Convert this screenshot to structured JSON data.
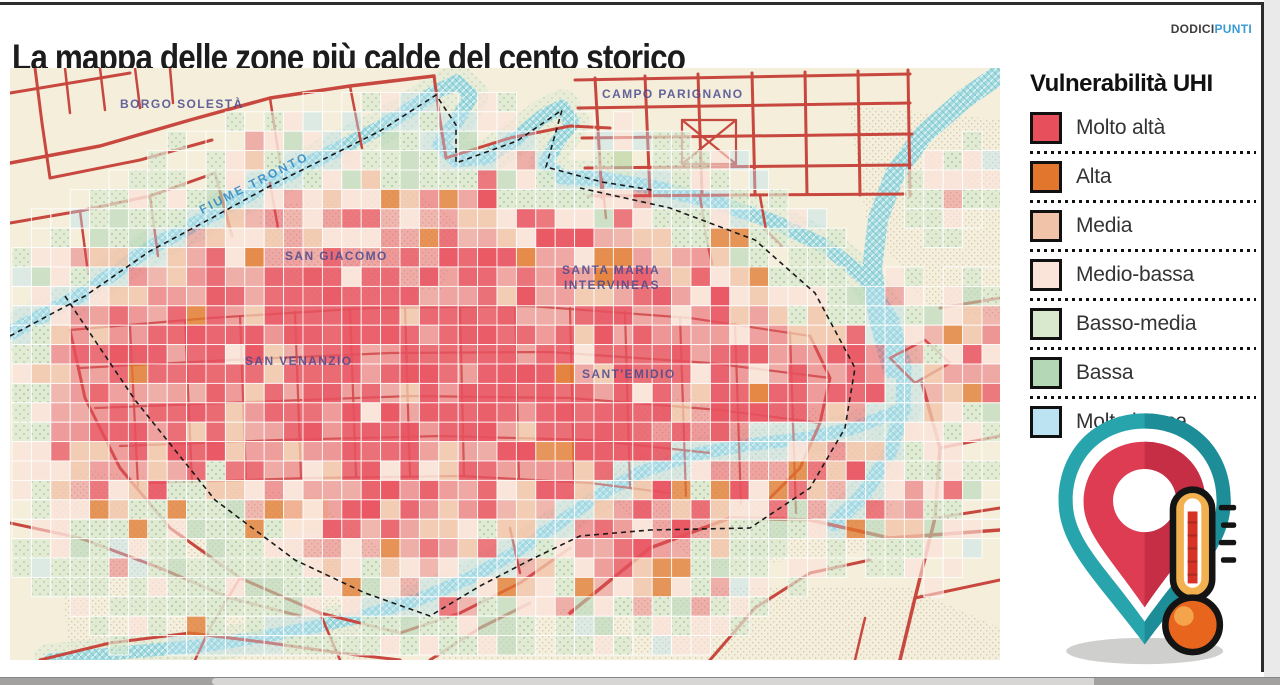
{
  "header": {
    "title": "La mappa delle zone più calde del cento storico",
    "brand_part1": "DODICI",
    "brand_part2": "PUNTI"
  },
  "legend": {
    "title": "Vulnerabilità UHI",
    "items": [
      {
        "label": "Molto altà",
        "color": "#e84f5c"
      },
      {
        "label": "Alta",
        "color": "#e2762d"
      },
      {
        "label": "Media",
        "color": "#f1c3a9"
      },
      {
        "label": "Medio-bassa",
        "color": "#fae3d9"
      },
      {
        "label": "Basso-media",
        "color": "#d9e9cd"
      },
      {
        "label": "Bassa",
        "color": "#b4d7b6"
      },
      {
        "label": "Molto bassa",
        "color": "#bce3f2"
      }
    ]
  },
  "map": {
    "background": "#f4eedb",
    "road_color": "#c8483f",
    "road_color_inner": "#c0463e",
    "river_color": "#a4dade",
    "boundary_color": "#1a1a1a",
    "district_label_color": "#4a4a8f",
    "river_label_color": "#2d85c5",
    "palette": {
      "molto_alta": "#e8515f",
      "alta": "#e2772e",
      "media": "#f1c3a9",
      "medio_bassa": "#fae3d9",
      "basso_media": "#dcead0",
      "bassa": "#b4d7b6",
      "molto_bassa": "#bce3f2"
    },
    "labels": [
      {
        "text": "BORGO SOLESTÀ",
        "x": 110,
        "y": 40,
        "rot": 0,
        "kind": "district"
      },
      {
        "text": "CAMPO PARIGNANO",
        "x": 592,
        "y": 30,
        "rot": 0,
        "kind": "district"
      },
      {
        "text": "FIUME TRONTO",
        "x": 192,
        "y": 146,
        "rot": -27,
        "kind": "river"
      },
      {
        "text": "SAN GIACOMO",
        "x": 275,
        "y": 192,
        "rot": 0,
        "kind": "district"
      },
      {
        "text": "SANTA MARIA",
        "x": 552,
        "y": 206,
        "rot": 0,
        "kind": "district"
      },
      {
        "text": "INTERVINEAS",
        "x": 554,
        "y": 221,
        "rot": 0,
        "kind": "district"
      },
      {
        "text": "SAN VENANZIO",
        "x": 235,
        "y": 297,
        "rot": 0,
        "kind": "district"
      },
      {
        "text": "SANT'EMIDIO",
        "x": 572,
        "y": 310,
        "rot": 0,
        "kind": "district"
      }
    ],
    "rivers": [
      {
        "w": 15,
        "pts": "0,265 75,225 140,180 200,148 260,115 320,85 370,60 402,40 426,24 447,14 461,28 446,54 430,76 446,92 477,89 507,70 532,49 552,39 562,55 546,76 536,96 552,109 592,111 642,119 702,133 762,153 817,179 856,211 881,251 894,296 893,341 879,386 854,426 824,456"
      },
      {
        "w": 20,
        "pts": "990,6 954,31 914,66 885,106 868,151 862,201 869,251 882,300"
      },
      {
        "w": 13,
        "pts": "40,592 120,584 200,577 280,564 350,549 410,531 462,509 506,484 546,457 586,429 631,404 681,387 736,377 791,371 841,361 886,344"
      }
    ],
    "boundaries": [
      {
        "pts": "0,268 75,228 140,183 200,151 260,118 320,88 370,63 426,27 446,57 446,95 507,73 552,42 536,99 592,114 642,122"
      },
      {
        "pts": "55,228 125,332 205,432 285,492 355,525 420,548 470,518 520,492 570,468 640,462 740,460 800,420 835,360 845,300 805,225 745,172 660,140 570,120"
      }
    ],
    "roads": [
      {
        "w": 3,
        "c": "o",
        "pts": "0,25 120,5"
      },
      {
        "w": 3.5,
        "c": "o",
        "pts": "0,95 90,78 180,52 260,30 340,18 424,8"
      },
      {
        "w": 3,
        "c": "o",
        "pts": "25,0 32,55 40,110"
      },
      {
        "w": 2.5,
        "c": "o",
        "pts": "55,0 60,45"
      },
      {
        "w": 2.5,
        "c": "o",
        "pts": "90,0 95,42"
      },
      {
        "w": 2.5,
        "c": "o",
        "pts": "125,0 130,40"
      },
      {
        "w": 2.5,
        "c": "o",
        "pts": "160,0 163,35"
      },
      {
        "w": 3,
        "c": "o",
        "pts": "40,110 130,92 202,72"
      },
      {
        "w": 3,
        "c": "o",
        "pts": "0,155 70,143 140,128 205,105"
      },
      {
        "w": 2.5,
        "c": "o",
        "pts": "140,128 148,188"
      },
      {
        "w": 2.5,
        "c": "o",
        "pts": "70,143 78,205"
      },
      {
        "w": 3,
        "c": "o",
        "pts": "205,105 222,168"
      },
      {
        "w": 2.5,
        "c": "o",
        "pts": "260,30 270,95"
      },
      {
        "w": 2.5,
        "c": "o",
        "pts": "340,18 352,80"
      },
      {
        "w": 3,
        "c": "o",
        "pts": "424,8 430,52 436,90"
      },
      {
        "w": 3,
        "c": "o",
        "pts": "436,90 500,70 560,58 600,60"
      },
      {
        "w": 3,
        "c": "o",
        "pts": "565,12 900,6"
      },
      {
        "w": 3,
        "c": "o",
        "pts": "568,40 900,35"
      },
      {
        "w": 3,
        "c": "o",
        "pts": "572,70 902,66"
      },
      {
        "w": 3,
        "c": "o",
        "pts": "575,100 900,97"
      },
      {
        "w": 3,
        "c": "o",
        "pts": "578,128 895,126"
      },
      {
        "w": 3,
        "c": "o",
        "pts": "585,10 592,130"
      },
      {
        "w": 3,
        "c": "o",
        "pts": "635,8 640,128"
      },
      {
        "w": 3,
        "c": "o",
        "pts": "688,6 692,127"
      },
      {
        "w": 3,
        "c": "o",
        "pts": "742,5 745,126"
      },
      {
        "w": 3,
        "c": "o",
        "pts": "795,4 797,126"
      },
      {
        "w": 3,
        "c": "o",
        "pts": "848,3 850,127"
      },
      {
        "w": 3,
        "c": "o",
        "pts": "898,2 900,128"
      },
      {
        "w": 2.2,
        "c": "o",
        "pts": "672,52 726,52 726,96 672,96 672,52"
      },
      {
        "w": 2.2,
        "c": "o",
        "pts": "672,52 726,96"
      },
      {
        "w": 2.2,
        "c": "o",
        "pts": "726,52 672,96"
      },
      {
        "w": 2.5,
        "c": "o",
        "pts": "750,128 756,162 772,178"
      },
      {
        "w": 2.5,
        "c": "o",
        "pts": "690,128 696,168 702,196"
      },
      {
        "w": 3,
        "c": "o",
        "pts": "930,240 990,230"
      },
      {
        "w": 2.5,
        "c": "o",
        "pts": "880,290 915,272 940,295 905,315 880,290"
      },
      {
        "w": 3.5,
        "c": "o",
        "pts": "912,315 930,380 925,450 905,530 890,592"
      },
      {
        "w": 3,
        "c": "o",
        "pts": "905,530 990,512"
      },
      {
        "w": 3,
        "c": "o",
        "pts": "925,450 990,440"
      },
      {
        "w": 3,
        "c": "o",
        "pts": "930,380 990,368"
      },
      {
        "w": 2.2,
        "c": "i",
        "pts": "60,262 200,250 360,240 520,238 680,250 800,268"
      },
      {
        "w": 2.2,
        "c": "i",
        "pts": "70,300 220,292 380,285 540,284 700,295 820,310"
      },
      {
        "w": 2.2,
        "c": "i",
        "pts": "85,340 240,334 400,328 560,330 710,342 810,355"
      },
      {
        "w": 2.2,
        "c": "i",
        "pts": "110,378 270,372 430,368 580,372 700,385"
      },
      {
        "w": 2.2,
        "c": "i",
        "pts": "140,415 300,410 450,408 580,415 660,425"
      },
      {
        "w": 2.2,
        "c": "i",
        "pts": "120,258 128,418"
      },
      {
        "w": 2.2,
        "c": "i",
        "pts": "175,252 182,415"
      },
      {
        "w": 2.2,
        "c": "i",
        "pts": "230,248 236,412"
      },
      {
        "w": 2.2,
        "c": "i",
        "pts": "285,244 291,410"
      },
      {
        "w": 2.2,
        "c": "i",
        "pts": "340,241 346,408"
      },
      {
        "w": 2.2,
        "c": "i",
        "pts": "395,239 400,408"
      },
      {
        "w": 2.2,
        "c": "i",
        "pts": "450,238 454,408"
      },
      {
        "w": 2.2,
        "c": "i",
        "pts": "505,238 509,410"
      },
      {
        "w": 2.2,
        "c": "i",
        "pts": "560,240 564,415"
      },
      {
        "w": 2.2,
        "c": "i",
        "pts": "615,244 620,420"
      },
      {
        "w": 2.2,
        "c": "i",
        "pts": "670,249 676,428"
      },
      {
        "w": 2.2,
        "c": "i",
        "pts": "725,256 731,436"
      },
      {
        "w": 2.2,
        "c": "i",
        "pts": "780,264 786,445"
      },
      {
        "w": 3,
        "c": "o",
        "pts": "60,262 75,330 110,400 160,460 230,510 310,545 390,565"
      },
      {
        "w": 3,
        "c": "o",
        "pts": "390,565 450,545 510,515 560,480"
      },
      {
        "w": 2.5,
        "c": "o",
        "pts": "310,545 330,592"
      },
      {
        "w": 2.5,
        "c": "o",
        "pts": "230,510 200,560 185,592"
      },
      {
        "w": 3,
        "c": "o",
        "pts": "800,268 820,310 810,355 790,400 760,430"
      },
      {
        "w": 3,
        "c": "o",
        "pts": "0,455 70,470 150,500 220,530 290,548"
      },
      {
        "w": 3,
        "c": "o",
        "pts": "30,592 100,575 180,565 260,575 330,585 390,592"
      },
      {
        "w": 3,
        "c": "o",
        "pts": "420,592 470,560 520,535"
      },
      {
        "w": 3.5,
        "c": "o",
        "pts": "560,545 640,480 720,450 800,452 880,470 990,462"
      },
      {
        "w": 3,
        "c": "o",
        "pts": "700,592 745,540 800,505 860,492"
      },
      {
        "w": 2.5,
        "c": "o",
        "pts": "845,592 855,550"
      },
      {
        "w": 2.5,
        "c": "o",
        "pts": "500,460 510,505"
      },
      {
        "w": 2.5,
        "c": "o",
        "pts": "260,115 268,160"
      },
      {
        "w": 2.5,
        "c": "o",
        "pts": "592,111 596,150"
      }
    ],
    "dots_blobs": [
      "M250,140 L400,118 L452,158 L432,222 L302,232 L252,192 Z",
      "M838,38 L995,52 L995,252 L915,236 L856,150 Z",
      "M615,330 L780,330 L900,382 L868,482 L700,502 L598,432 Z",
      "M40,398 L300,428 L420,518 L380,592 L60,592 Z",
      "M430,560 L700,518 L900,520 L990,560 L990,592 L425,592 Z"
    ],
    "yellow_patches": [
      {
        "x": 598,
        "y": 84,
        "w": 26,
        "h": 30
      },
      {
        "x": 272,
        "y": 430,
        "w": 46,
        "h": 34
      }
    ],
    "yellow_color": "#f4e7a9",
    "grid": {
      "cell": 19.4,
      "cols": 51,
      "rows": 30,
      "ox": 2,
      "oy": 5,
      "seed": 7
    },
    "heat_centers": [
      [
        170,
        300,
        170,
        1.0
      ],
      [
        300,
        290,
        210,
        1.02
      ],
      [
        450,
        290,
        220,
        1.0
      ],
      [
        600,
        310,
        210,
        1.0
      ],
      [
        730,
        330,
        165,
        0.92
      ],
      [
        850,
        330,
        120,
        0.85
      ],
      [
        380,
        380,
        185,
        0.85
      ],
      [
        620,
        410,
        165,
        0.8
      ],
      [
        120,
        360,
        115,
        0.9
      ],
      [
        260,
        120,
        80,
        0.55
      ],
      [
        420,
        80,
        65,
        0.5
      ],
      [
        220,
        500,
        200,
        0.3
      ],
      [
        420,
        555,
        160,
        0.28
      ],
      [
        90,
        450,
        130,
        0.28
      ],
      [
        480,
        480,
        145,
        0.5
      ],
      [
        963,
        290,
        85,
        0.6
      ],
      [
        940,
        120,
        55,
        0.42
      ],
      [
        900,
        430,
        90,
        0.5
      ]
    ]
  },
  "pin_icon": {
    "teal": "#28a4ac",
    "teal_dark": "#1d8e98",
    "red": "#dd3c52",
    "red_dark": "#c52e44",
    "white": "#ffffff",
    "amber": "#f2b14e",
    "column_red": "#d63226",
    "bulb": "#e8651d",
    "bulb_hi": "#f6a44c",
    "outline": "#141414",
    "shadow": "#cfcfcd"
  }
}
